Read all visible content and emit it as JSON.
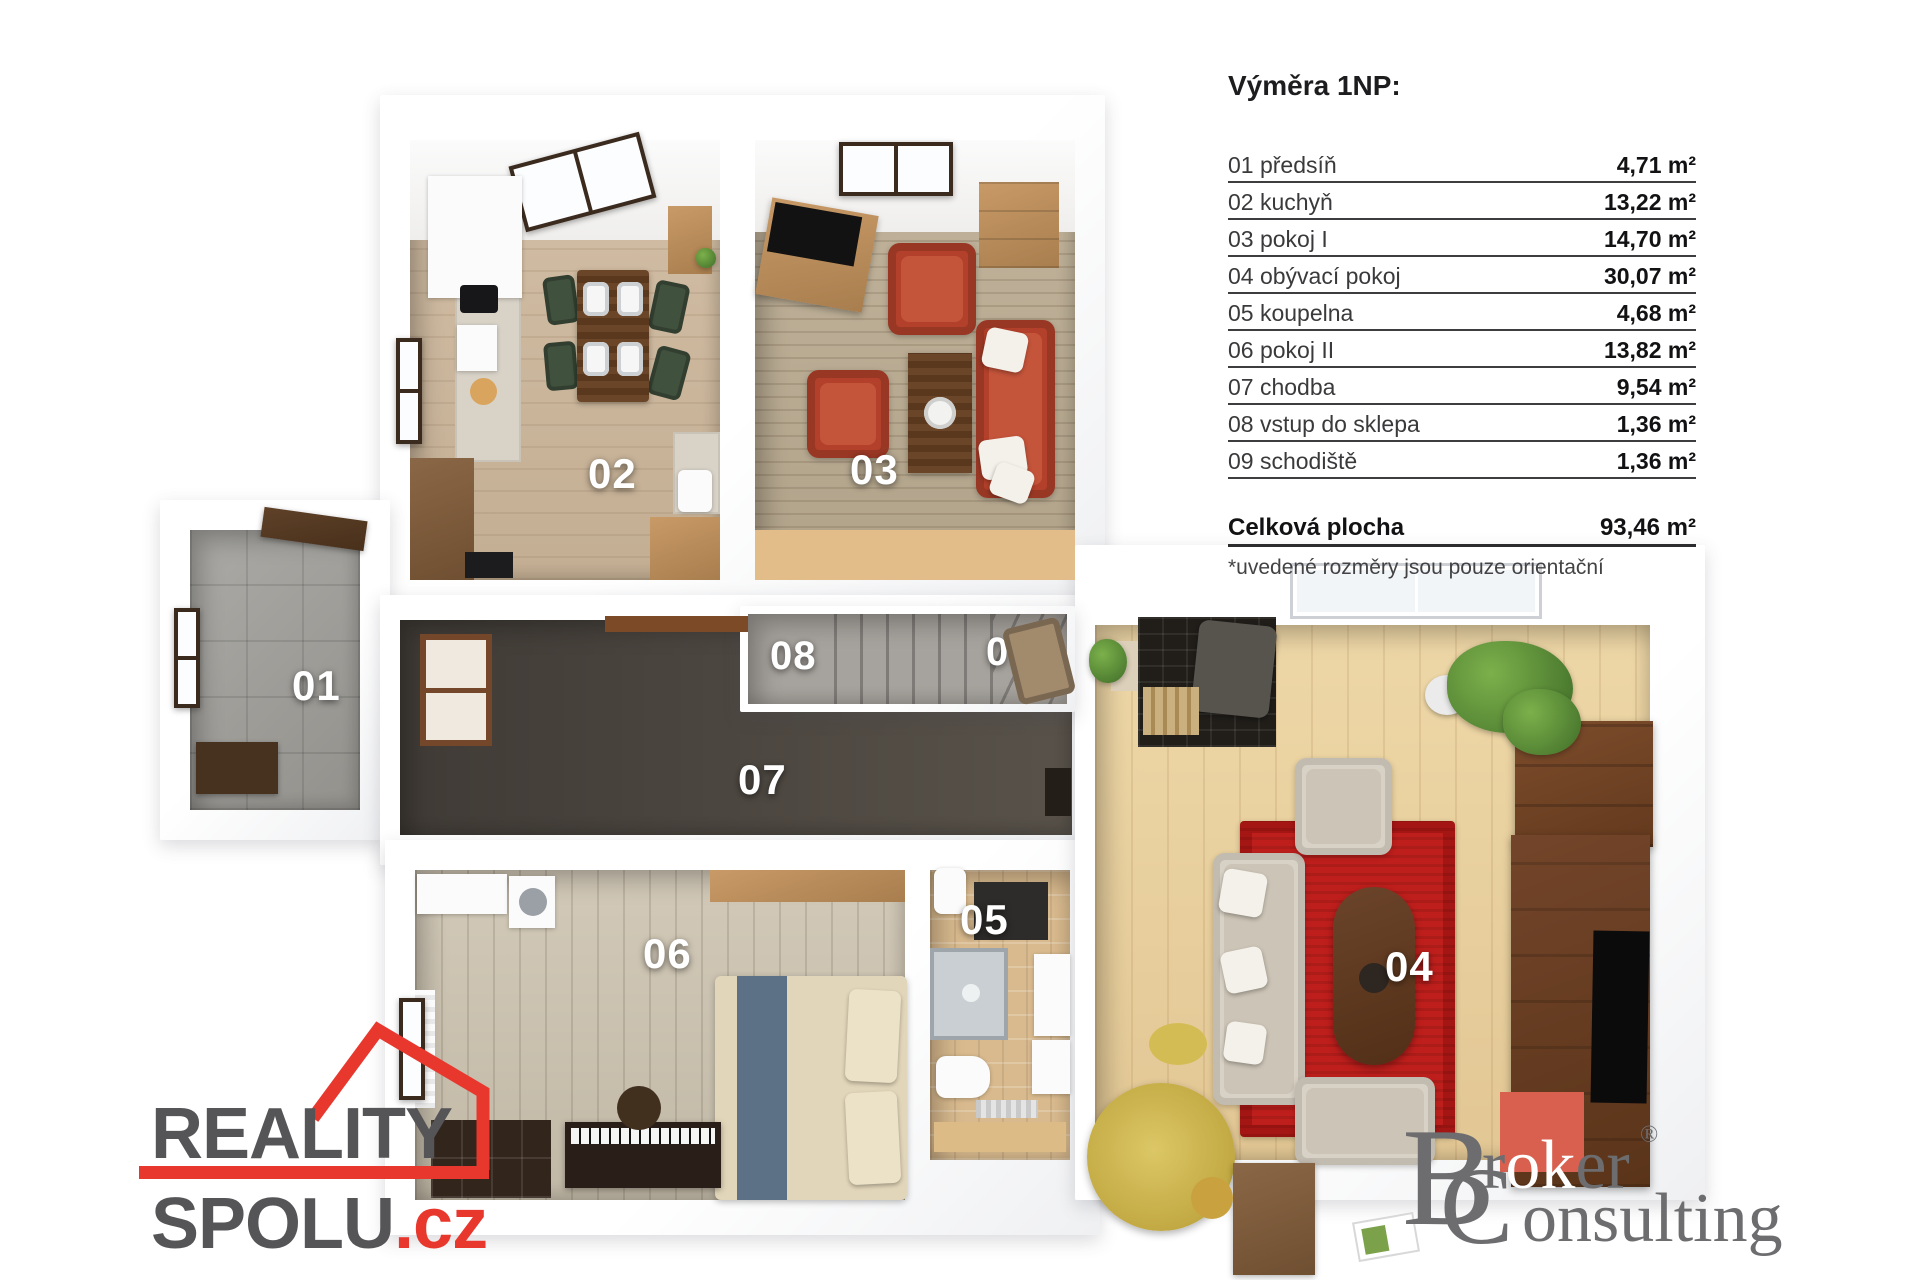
{
  "legend": {
    "title": "Výměra 1NP:",
    "rows": [
      {
        "label": "01 předsíň",
        "value": "4,71 m²"
      },
      {
        "label": "02 kuchyň",
        "value": "13,22 m²"
      },
      {
        "label": "03 pokoj I",
        "value": "14,70 m²"
      },
      {
        "label": "04 obývací pokoj",
        "value": "30,07 m²"
      },
      {
        "label": "05 koupelna",
        "value": "4,68 m²"
      },
      {
        "label": "06 pokoj II",
        "value": "13,82 m²"
      },
      {
        "label": "07 chodba",
        "value": "9,54 m²"
      },
      {
        "label": "08 vstup do sklepa",
        "value": "1,36 m²"
      },
      {
        "label": "09 schodiště",
        "value": "1,36 m²"
      }
    ],
    "total_label": "Celková plocha",
    "total_value": "93,46 m²",
    "footnote": "*uvedené rozměry jsou pouze orientační"
  },
  "plan": {
    "room_numbers": [
      "01",
      "02",
      "03",
      "04",
      "05",
      "06",
      "07",
      "08",
      "09"
    ]
  },
  "logos": {
    "reality": {
      "line1": "REALITY",
      "line2": "SPOLU",
      "tld": ".cz"
    },
    "broker": {
      "cap1": "B",
      "r1a": "r",
      "r1b": "ok",
      "r1c": "er",
      "reg": "®",
      "cap2": "C",
      "rest2": "onsulting"
    }
  },
  "colors": {
    "reality_red": "#e8382e",
    "broker_red": "#d9604e",
    "rug_red": "#bf1f1c",
    "sofa_red": "#b2402a",
    "label_white": "#ffffff"
  }
}
